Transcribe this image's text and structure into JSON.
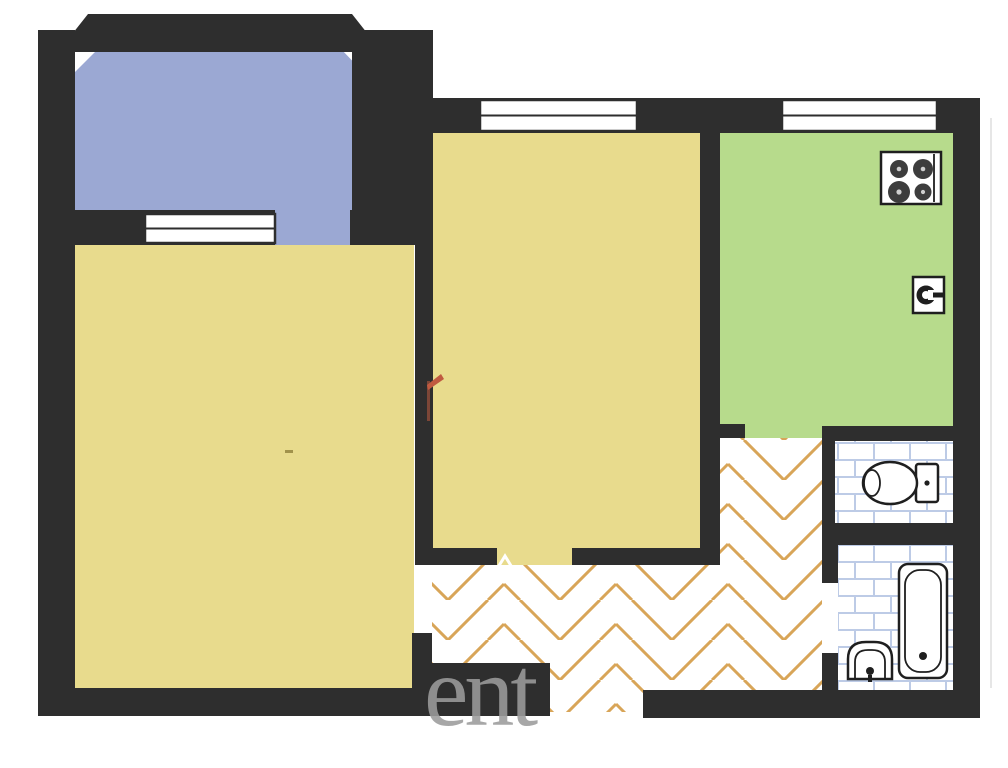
{
  "watermark": {
    "text": "ent"
  },
  "colors": {
    "page": "#ffffff",
    "wall": "#2e2e2e",
    "balcony": "#9ba8d3",
    "room": "#e8db8d",
    "kitchen": "#b7db8c",
    "parquet_line": "#d8a558",
    "tile_line": "#bdcbe6",
    "fixture": "#1f1f1f",
    "mark_red": "#c05a40",
    "mark_dark": "#8a4a38",
    "mark_olive": "#8a7a35",
    "watermark": "#9c9c9c",
    "faint": "#e6e6e6"
  },
  "plan": {
    "type": "apartment-floor-plan",
    "rooms": [
      {
        "id": "balcony",
        "floor": "solid",
        "color_key": "balcony"
      },
      {
        "id": "living-room",
        "floor": "solid",
        "color_key": "room"
      },
      {
        "id": "bedroom",
        "floor": "solid",
        "color_key": "room"
      },
      {
        "id": "kitchen",
        "floor": "solid",
        "color_key": "kitchen"
      },
      {
        "id": "hallway",
        "floor": "herringbone-parquet",
        "color_key": "parquet_line"
      },
      {
        "id": "wc",
        "floor": "tile-grid",
        "color_key": "tile_line"
      },
      {
        "id": "bathroom",
        "floor": "tile-grid",
        "color_key": "tile_line"
      }
    ],
    "fixtures": [
      {
        "id": "stove",
        "room": "kitchen",
        "burners": 4
      },
      {
        "id": "kitchen-sink",
        "room": "kitchen"
      },
      {
        "id": "toilet",
        "room": "wc"
      },
      {
        "id": "bathtub",
        "room": "bathroom"
      },
      {
        "id": "wash-basin",
        "room": "bathroom"
      }
    ],
    "windows": [
      {
        "id": "balcony-window",
        "wall": "balcony-south"
      },
      {
        "id": "bedroom-window",
        "wall": "north"
      },
      {
        "id": "kitchen-window",
        "wall": "north"
      }
    ],
    "openings": [
      {
        "id": "balcony-door"
      },
      {
        "id": "bedroom-door"
      },
      {
        "id": "kitchen-door"
      },
      {
        "id": "living-room-door"
      },
      {
        "id": "bathroom-door"
      },
      {
        "id": "entrance-door"
      }
    ],
    "annotations": [
      {
        "id": "red-annotation-mark",
        "near": "bedroom-west-wall"
      },
      {
        "id": "small-dash-mark",
        "near": "living-room-center"
      }
    ]
  }
}
